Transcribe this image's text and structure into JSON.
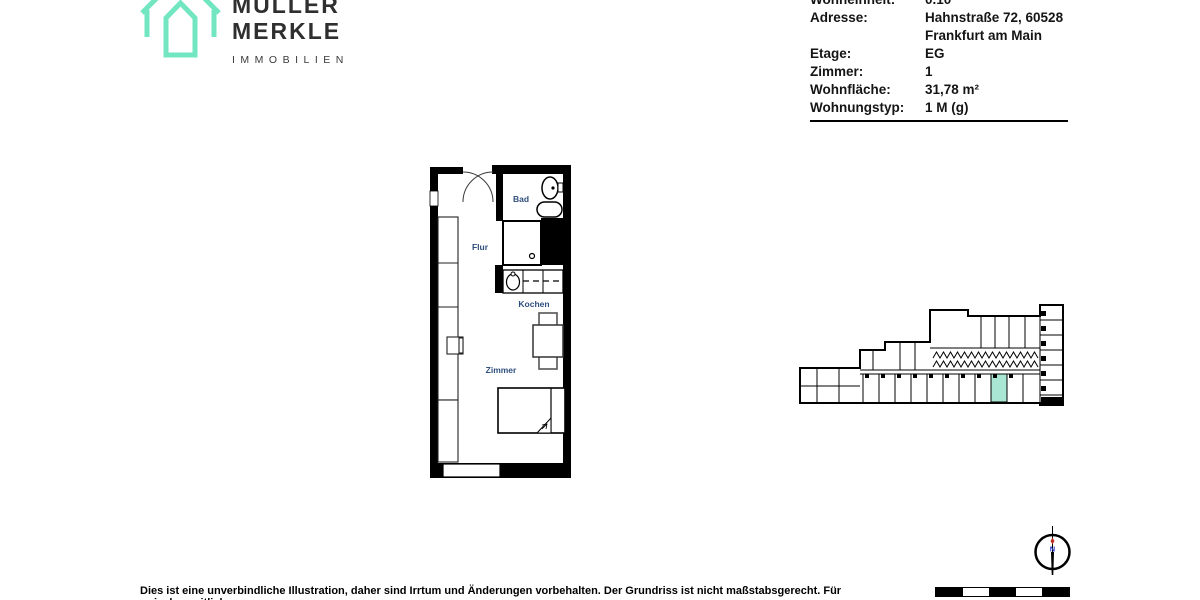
{
  "logo": {
    "line1": "MÜLLER",
    "line2": "MERKLE",
    "subline": "IMMOBILIEN"
  },
  "info_table": {
    "rows": [
      {
        "label": "Wohneinheit:",
        "value": "0.10"
      },
      {
        "label": "Adresse:",
        "value": "Hahnstraße 72, 60528",
        "value2": "Frankfurt am Main"
      },
      {
        "label": "Etage:",
        "value": "EG"
      },
      {
        "label": "Zimmer:",
        "value": "1"
      },
      {
        "label": "Wohnfläche:",
        "value": "31,78 m²"
      },
      {
        "label": "Wohnungstyp:",
        "value": "1 M (g)"
      }
    ]
  },
  "floor_plan": {
    "rooms": {
      "bad": "Bad",
      "flur": "Flur",
      "kochen": "Kochen",
      "zimmer": "Zimmer"
    },
    "label_color": "#2e4e7e"
  },
  "site_plan": {
    "highlight_color": "#a9e6d4"
  },
  "compass": {
    "north_label": "N"
  },
  "footer": {
    "disclaimer": "Dies ist eine unverbindliche Illustration, daher sind Irrtum und Änderungen vorbehalten. Der Grundriss ist nicht maßstabsgerecht. Für zwischenzeitliche"
  },
  "colors": {
    "brand_teal": "#71e6c1"
  }
}
